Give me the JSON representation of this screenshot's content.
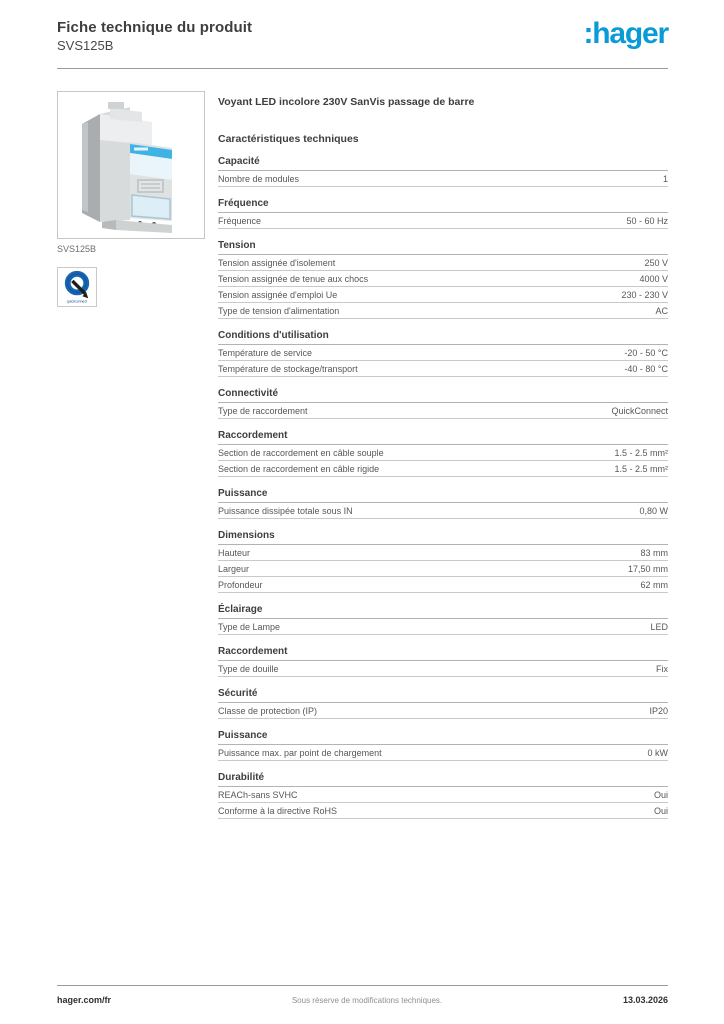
{
  "header": {
    "title": "Fiche technique du produit",
    "product_code": "SVS125B",
    "brand_logo_text": ":hager",
    "brand_color": "#0a9bd7"
  },
  "product_panel": {
    "image_caption": "SVS125B",
    "quickconnect_logo_text": "quickconnect"
  },
  "main": {
    "product_title": "Voyant LED incolore 230V SanVis passage de barre",
    "tech_title": "Caractéristiques techniques"
  },
  "sections": [
    {
      "title": "Capacité",
      "rows": [
        {
          "label": "Nombre de modules",
          "value": "1"
        }
      ]
    },
    {
      "title": "Fréquence",
      "rows": [
        {
          "label": "Fréquence",
          "value": "50 - 60 Hz"
        }
      ]
    },
    {
      "title": "Tension",
      "rows": [
        {
          "label": "Tension assignée d'isolement",
          "value": "250 V"
        },
        {
          "label": "Tension assignée de tenue aux chocs",
          "value": "4000 V"
        },
        {
          "label": "Tension assignée d'emploi Ue",
          "value": "230 - 230 V"
        },
        {
          "label": "Type de tension d'alimentation",
          "value": "AC"
        }
      ]
    },
    {
      "title": "Conditions d'utilisation",
      "rows": [
        {
          "label": "Température de service",
          "value": "-20 - 50 °C"
        },
        {
          "label": "Température de stockage/transport",
          "value": "-40 - 80 °C"
        }
      ]
    },
    {
      "title": "Connectivité",
      "rows": [
        {
          "label": "Type de raccordement",
          "value": "QuickConnect"
        }
      ]
    },
    {
      "title": "Raccordement",
      "rows": [
        {
          "label": "Section de raccordement en câble souple",
          "value": "1.5 - 2.5 mm²"
        },
        {
          "label": "Section de raccordement en câble rigide",
          "value": "1.5 - 2.5 mm²"
        }
      ]
    },
    {
      "title": "Puissance",
      "rows": [
        {
          "label": "Puissance dissipée totale sous IN",
          "value": "0,80 W"
        }
      ]
    },
    {
      "title": "Dimensions",
      "rows": [
        {
          "label": "Hauteur",
          "value": "83 mm"
        },
        {
          "label": "Largeur",
          "value": "17,50 mm"
        },
        {
          "label": "Profondeur",
          "value": "62 mm"
        }
      ]
    },
    {
      "title": "Éclairage",
      "rows": [
        {
          "label": "Type de Lampe",
          "value": "LED"
        }
      ]
    },
    {
      "title": "Raccordement",
      "rows": [
        {
          "label": "Type de douille",
          "value": "Fix"
        }
      ]
    },
    {
      "title": "Sécurité",
      "rows": [
        {
          "label": "Classe de protection (IP)",
          "value": "IP20"
        }
      ]
    },
    {
      "title": "Puissance",
      "rows": [
        {
          "label": "Puissance max. par point de chargement",
          "value": "0 kW"
        }
      ]
    },
    {
      "title": "Durabilité",
      "rows": [
        {
          "label": "REACh-sans SVHC",
          "value": "Oui"
        },
        {
          "label": "Conforme à la directive RoHS",
          "value": "Oui"
        }
      ]
    }
  ],
  "footer": {
    "link": "hager.com/fr",
    "note": "Sous réserve de modifications techniques.",
    "date": "13.03.2026"
  }
}
